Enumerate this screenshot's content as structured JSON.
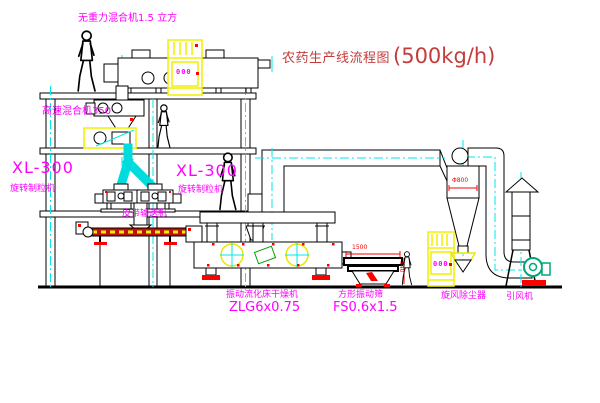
{
  "title": {
    "text": "农药生产线流程图",
    "capacity": "(500kg/h)"
  },
  "equipment_labels": {
    "gravity_mixer": "无重力混合机1.5 立方",
    "high_speed_mixer": "高速混合机350",
    "granulator_left": {
      "model": "XL-300",
      "name": "旋转制粒机"
    },
    "granulator_right": {
      "model": "XL-300",
      "name": "旋转制粒机"
    },
    "belt_conveyor": "皮带输送机",
    "fluid_bed_dryer": {
      "name": "振动流化床干燥机",
      "model": "ZLG6x0.75"
    },
    "square_sieve": {
      "name": "方形振动筛",
      "model": "FS0.6x1.5"
    },
    "cyclone": "旋风除尘器",
    "induced_draft_fan": "引风机"
  },
  "dimensions": {
    "cyclone_diameter": "Φ800",
    "sieve_length": "1500",
    "sieve_height": "540"
  },
  "control_cabinets": {
    "cabinet1_display": "000",
    "cabinet2_display": "000"
  },
  "colors": {
    "label_magenta": "#ff00ff",
    "title_red": "#c43c3c",
    "line_black": "#000000",
    "centerline_cyan": "#00e8e8",
    "highlight_yellow": "#f0f000",
    "accent_red": "#ff0000",
    "machine_green": "#00a878"
  }
}
